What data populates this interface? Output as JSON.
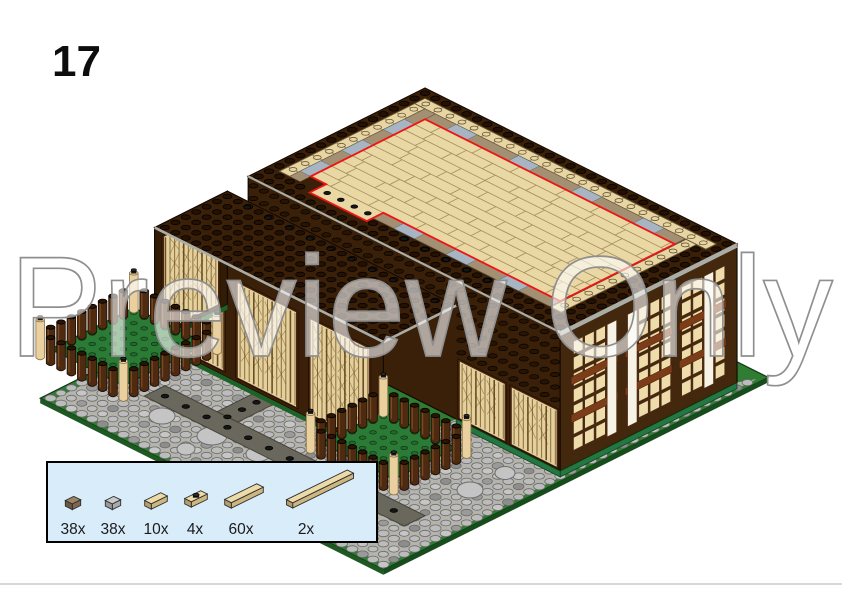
{
  "step": {
    "number": "17"
  },
  "watermark": {
    "text": "Preview Only"
  },
  "parts_callout": {
    "parts": [
      {
        "count": "38x",
        "part": "tile-1x1",
        "color_name": "dark-tan-brown"
      },
      {
        "count": "38x",
        "part": "tile-1x1",
        "color_name": "light-gray"
      },
      {
        "count": "10x",
        "part": "tile-1x2",
        "color_name": "tan"
      },
      {
        "count": "4x",
        "part": "jumper-plate-1x2",
        "color_name": "tan-black-stud"
      },
      {
        "count": "60x",
        "part": "tile-1x4",
        "color_name": "tan"
      },
      {
        "count": "2x",
        "part": "tile-1x8",
        "color_name": "tan"
      }
    ]
  },
  "model": {
    "description": "isometric LEGO timber-framed hall, step 17: tan tile upper floor outlined in red",
    "palette": {
      "wall_brown": "#3a2008",
      "wall_brown_right": "#44280d",
      "stud_brown": "#281403",
      "roof_trim_gray": "#a9ada6",
      "floor_tan": "#e9d7a4",
      "plank_line": "#a28c5c",
      "red_highlight": "#ee1414",
      "balustrade_tan": "#e7d6a4",
      "border_tan": "#a39073",
      "tile_gray": "#a7b4c2",
      "lattice_tan": "#e4d09d",
      "lattice_frame": "#4a2410",
      "pane_tan": "#eedcab",
      "pane_white": "#f7f2e6",
      "spandrel_brown": "#7b3c17",
      "cobble_gray": "#bcbcbc",
      "path_gray": "#6a675c",
      "plate_green": "#2e7d32",
      "plate_edge_green": "#1c5a22",
      "planter_green": "#2b7a36",
      "barrel_brown": "#4e2a10",
      "post_tan": "#ead09e",
      "black_stud": "#161616",
      "box_bg": "#d9ecfa",
      "box_border": "#000000",
      "watermark_fill": "rgba(255,255,255,0.60)",
      "watermark_stroke": "#8f8f8f",
      "divider_gray": "#d8d8d8"
    }
  }
}
